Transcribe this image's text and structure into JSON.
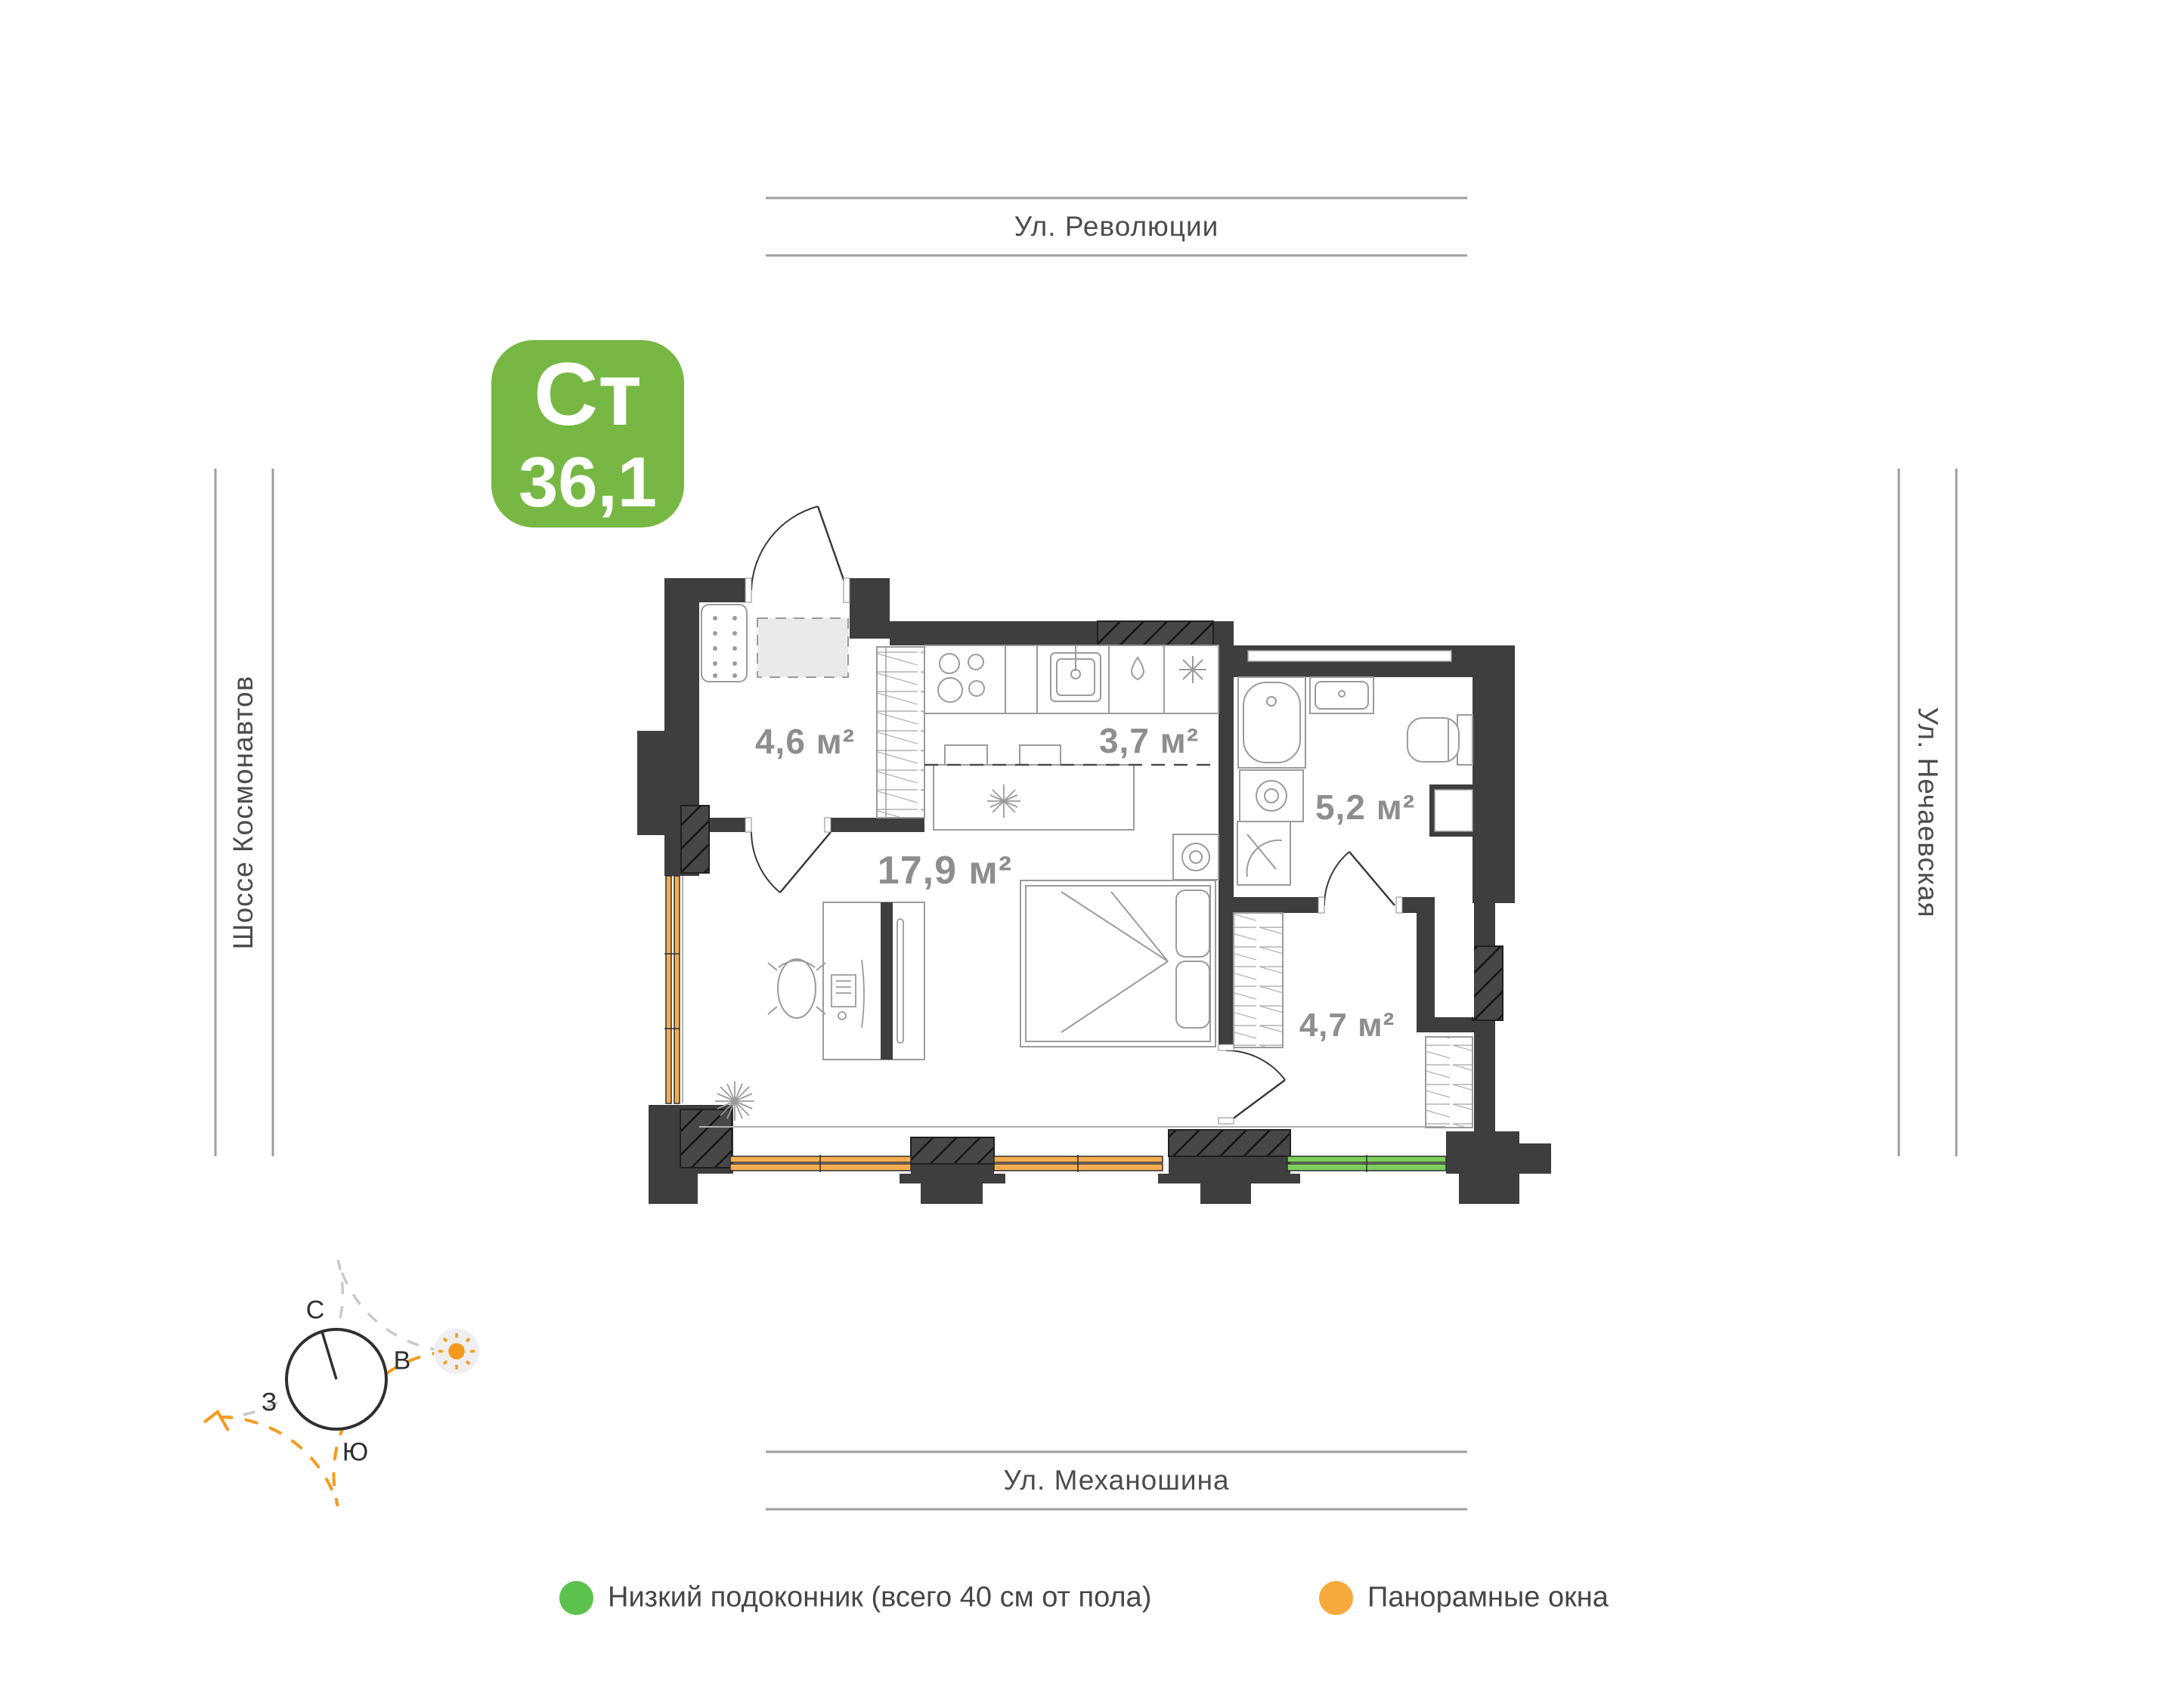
{
  "badge": {
    "type": "Ст",
    "area": "36,1",
    "bg": "#76B843"
  },
  "streets": {
    "top": "Ул. Революции",
    "bottom": "Ул. Механошина",
    "left": "Шоссе Космонавтов",
    "right": "Ул. Нечаевская"
  },
  "rooms": [
    {
      "name": "hallway",
      "area_label": "4,6 м²"
    },
    {
      "name": "kitchen",
      "area_label": "3,7 м²"
    },
    {
      "name": "living-room",
      "area_label": "17,9 м²"
    },
    {
      "name": "bathroom",
      "area_label": "5,2 м²"
    },
    {
      "name": "dressing",
      "area_label": "4,7 м²"
    }
  ],
  "compass": {
    "north": "С",
    "east": "В",
    "west": "З",
    "south": "Ю"
  },
  "legend": [
    {
      "label": "Низкий подоконник (всего 40 см от пола)",
      "color": "#5BC24D"
    },
    {
      "label": "Панорамные окна",
      "color": "#F6A93C"
    }
  ],
  "colors": {
    "walls": "#3E3E3E",
    "hatch_block": "#474747",
    "window_orange": "#F6AD4F",
    "window_green": "#7CCF5A",
    "accent_orange": "#F59A1D",
    "label_gray": "#8E8E8E"
  }
}
